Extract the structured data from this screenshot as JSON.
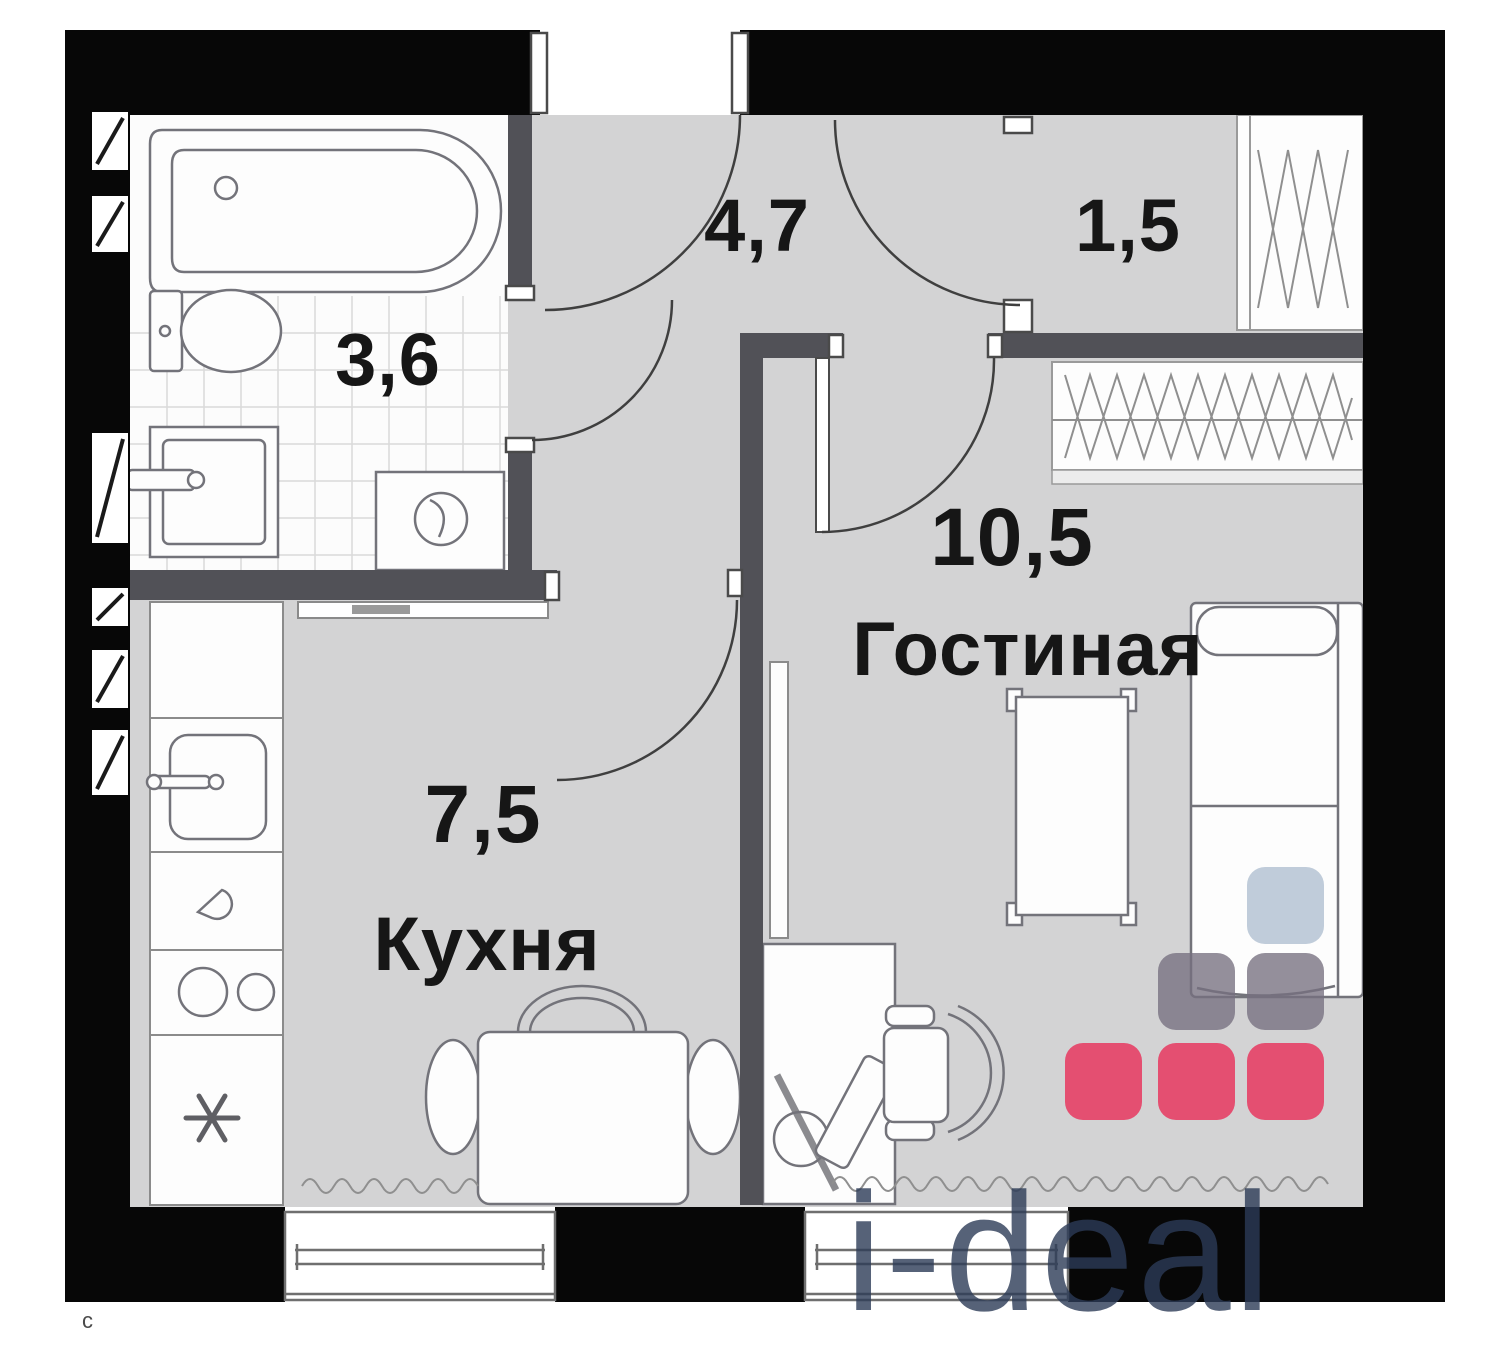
{
  "rooms": {
    "bathroom": {
      "area": "3,6"
    },
    "hallway": {
      "area": "4,7"
    },
    "closet": {
      "area": "1,5"
    },
    "living": {
      "area": "10,5",
      "name": "Гостиная"
    },
    "kitchen": {
      "area": "7,5",
      "name": "Кухня"
    }
  },
  "watermark": {
    "logo_text": "i-deal",
    "corner_char": "с",
    "logo_colors": {
      "blue": "#bdc9d8",
      "gray": "#76707f",
      "pink": "#e5486b",
      "text": "#2c3b57"
    }
  },
  "colors": {
    "outer_wall": "#070707",
    "inner_wall": "#515157",
    "floor": "#d3d3d4",
    "bathroom_floor": "#fcfcfc",
    "fixture_stroke": "#73737a",
    "label_text": "#161616"
  }
}
